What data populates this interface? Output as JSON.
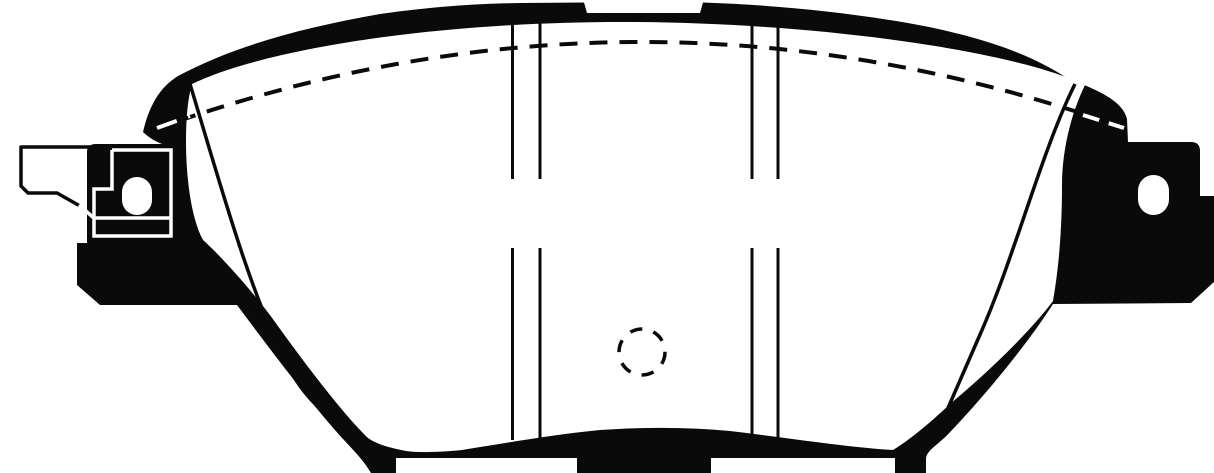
{
  "meta": {
    "title": "Brake pad technical line drawing",
    "figure_type": "black-and-white technical illustration",
    "description": "Front view line drawing of a disc brake pad: black backing-plate silhouette surrounding a white friction surface, two pairs of vertical slot lines, a dashed wear-indicator arc across the top, a dashed center circle, thin chamfer lines converging at both lower sides, left and right mounting ears with oval lug holes, an abutment clip drawn in outline on the left ear, a notched top edge and tabbed bottom edge."
  },
  "colors": {
    "ink": "#0a0a0a",
    "paper": "#ffffff"
  }
}
